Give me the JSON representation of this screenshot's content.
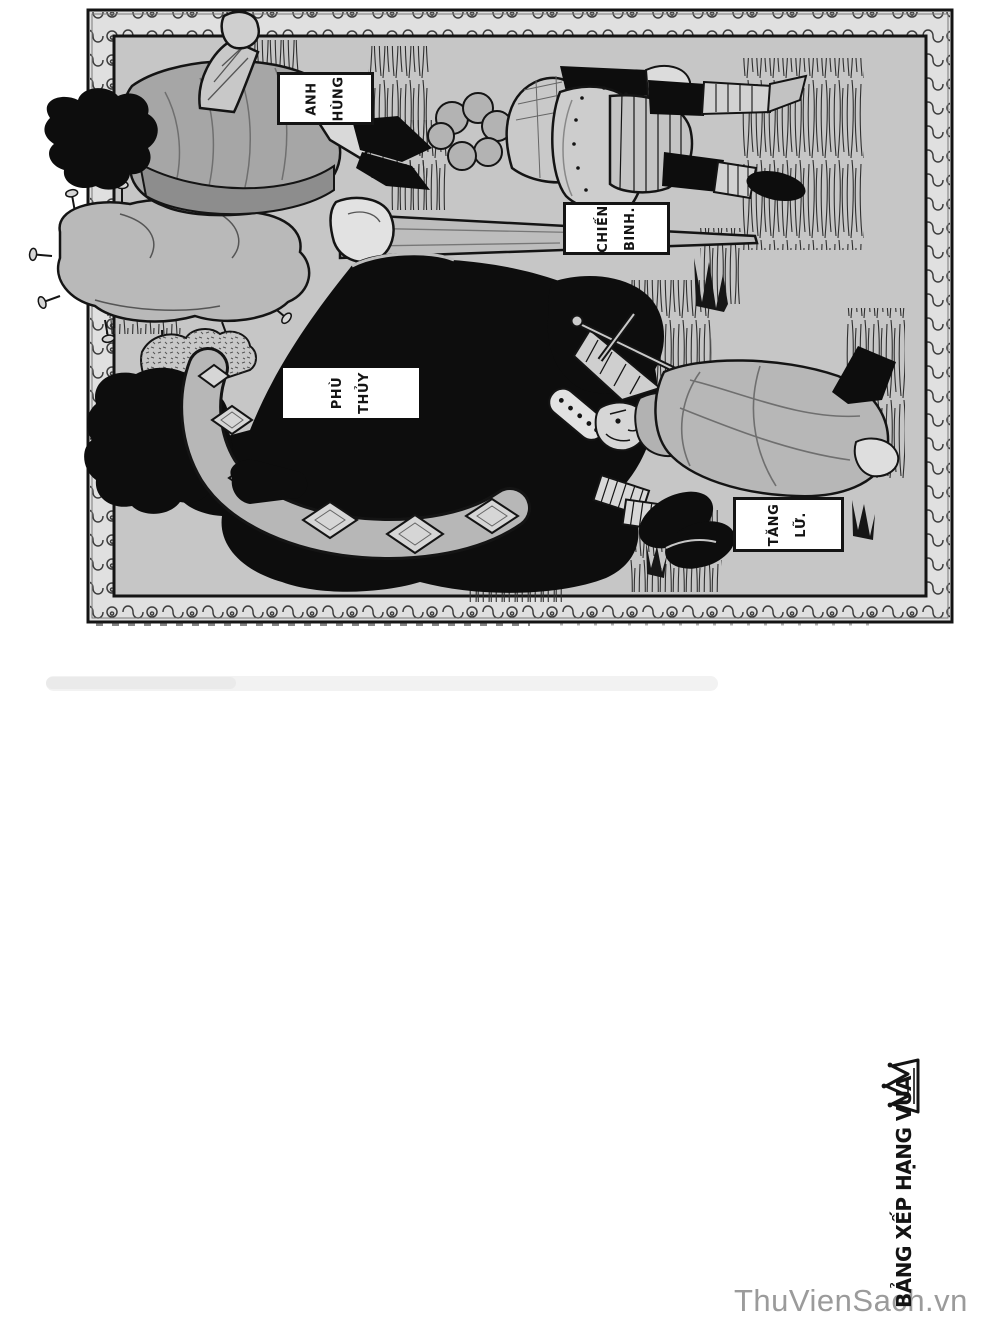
{
  "page": {
    "background": "#ffffff"
  },
  "panel": {
    "interior_color": "#c6c6c6",
    "frame_color": "#141414",
    "band_color": "#e0e0e0",
    "ornament_style": "running-scroll"
  },
  "figures": [
    {
      "id": "hero",
      "label_line1": "ANH",
      "label_line2": "HÙNG"
    },
    {
      "id": "warrior",
      "label_line1": "CHIẾN",
      "label_line2": "BINH."
    },
    {
      "id": "wizard",
      "label_line1": "PHÙ",
      "label_line2": "THỦY"
    },
    {
      "id": "priest",
      "label_line1": "TĂNG",
      "label_line2": "LỮ."
    }
  ],
  "side_title": {
    "text": "BẢNG XẾP HẠNG VUA",
    "icon": "crown-doodle",
    "color": "#141414"
  },
  "watermark": {
    "text": "ThuVienSach.vn",
    "color": "#9b9b9b"
  }
}
